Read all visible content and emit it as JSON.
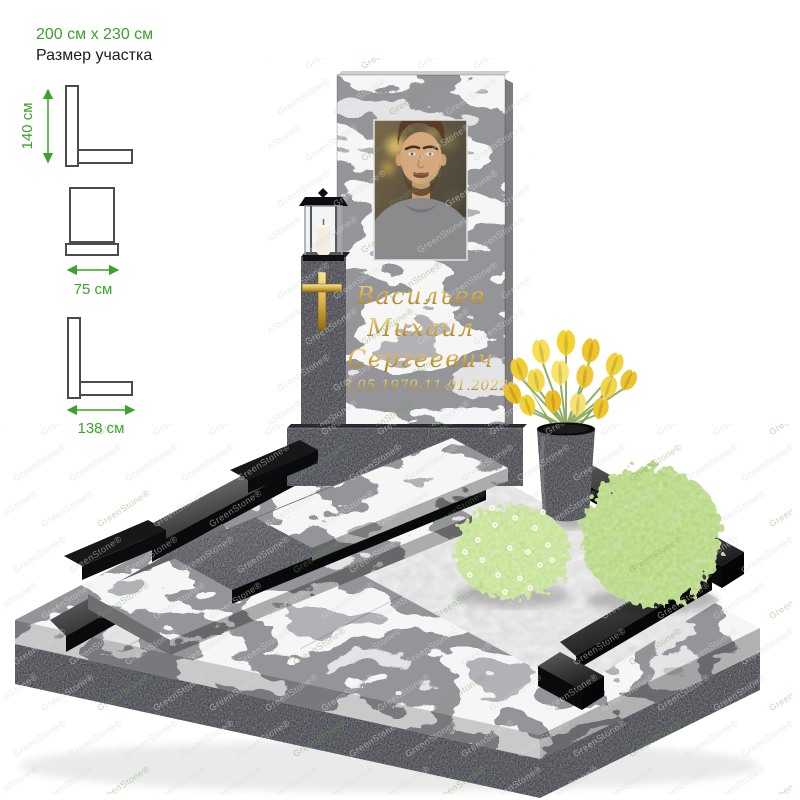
{
  "annotations": {
    "plot_size_value": "200 см x 230 см",
    "plot_size_label": "Размер участка",
    "dims": [
      {
        "id": "stele-height",
        "label": "140 см"
      },
      {
        "id": "stele-width",
        "label": "75 см"
      },
      {
        "id": "tombstone-length",
        "label": "138 см"
      }
    ]
  },
  "monument": {
    "epitaph": {
      "surname": "Васильев",
      "name": "Михаил",
      "patronymic": "Сергеевич",
      "dates": "08.05.1979-11.01.2022"
    }
  },
  "watermark": {
    "text": "GreenStone®",
    "color_light": "rgba(213,218,213,0.55)",
    "color_green": "rgba(115,165,90,0.45)"
  },
  "colors": {
    "accent_green": "#3BA22B",
    "gold": "#C9A23C",
    "black_granite": "#141416"
  }
}
